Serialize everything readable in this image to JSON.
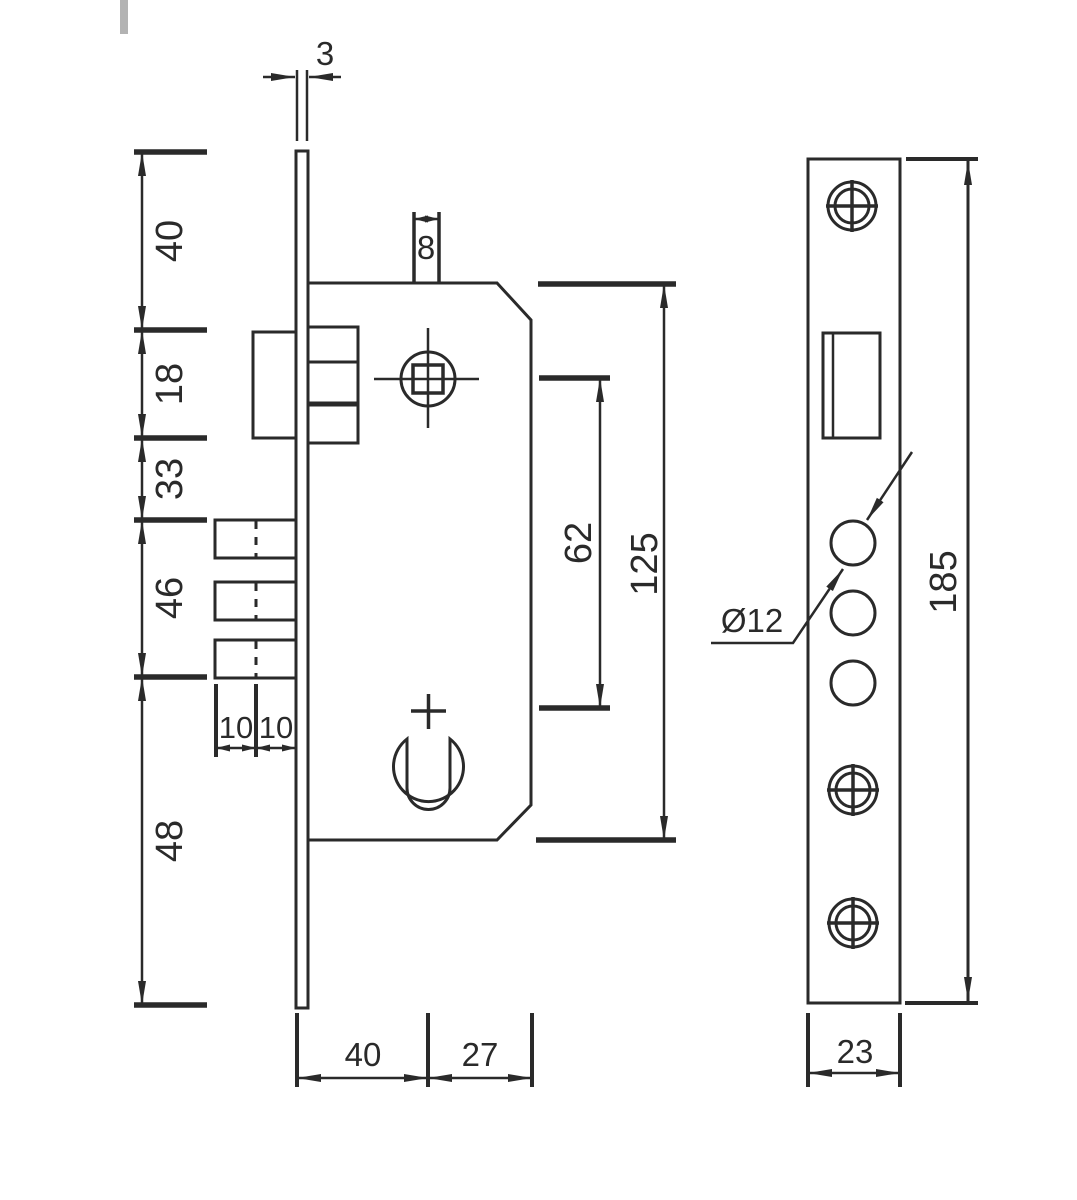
{
  "colors": {
    "line": "#2a2a2a",
    "background": "#ffffff",
    "corner_mark": "#b3b3b3"
  },
  "side_view": {
    "faceplate_thickness_mm": "3",
    "spindle_square_mm": "8",
    "height_segments": [
      {
        "label": "40"
      },
      {
        "label": "18"
      },
      {
        "label": "33"
      },
      {
        "label": "46"
      },
      {
        "label": "48"
      }
    ],
    "bolt_throw_left": "10",
    "bolt_throw_right": "10",
    "spindle_to_cylinder": "62",
    "case_height": "125",
    "backset": "40",
    "case_rear": "27"
  },
  "front_view": {
    "bolt_hole_diameter": "Ø12",
    "faceplate_height": "185",
    "faceplate_width": "23"
  }
}
